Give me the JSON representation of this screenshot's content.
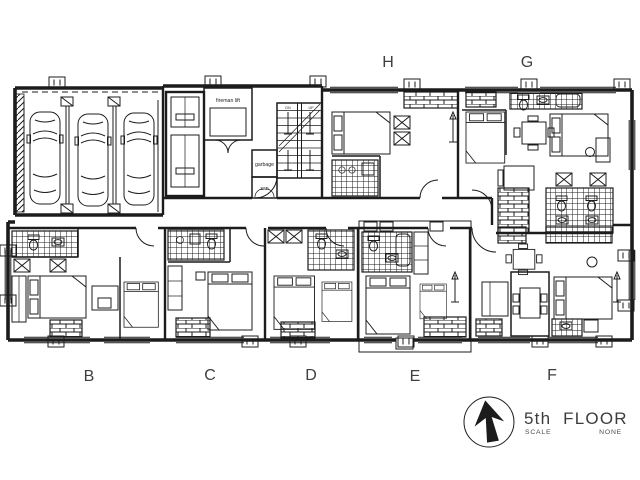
{
  "drawing": {
    "background_color": "#ffffff",
    "line_color": "#1c1c1c",
    "units": {
      "top": [
        {
          "id": "H",
          "label": "H"
        },
        {
          "id": "G",
          "label": "G"
        }
      ],
      "bottom": [
        {
          "id": "B",
          "label": "B"
        },
        {
          "id": "C",
          "label": "C"
        },
        {
          "id": "D",
          "label": "D"
        },
        {
          "id": "E",
          "label": "E"
        },
        {
          "id": "F",
          "label": "F"
        }
      ]
    },
    "highlight": {
      "unit": "E",
      "color": "#23a44c"
    },
    "core_labels": {
      "fireman_lift": "fireman lift",
      "garbage": "garbage",
      "san": "san",
      "stair_down": "DN",
      "stair_up": "UP"
    }
  },
  "title_block": {
    "title": "5th FLOOR PLAN",
    "scale_label": "SCALE",
    "scale_value": "NONE",
    "north_icon": "north-arrow"
  }
}
